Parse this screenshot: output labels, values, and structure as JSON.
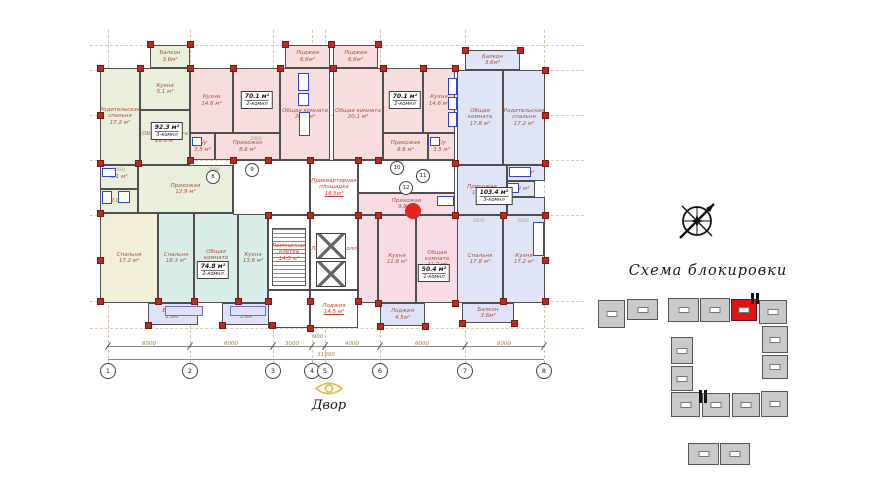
{
  "labels": {
    "scheme_title": "Схема блокировки",
    "courtyard": "Двор",
    "total_dim": "31900"
  },
  "fills": {
    "green": "#e9efda",
    "yellow": "#f3eed8",
    "teal": "#d9eee9",
    "pink": "#f7dddd",
    "pink2": "#f9dbe6",
    "blue": "#dfe4f6",
    "per": "#dfe2f6",
    "white": "#ffffff"
  },
  "grid": {
    "vxs": [
      108,
      190,
      273,
      312,
      325,
      380,
      465,
      544
    ],
    "hys": [
      45,
      70,
      115,
      160,
      215,
      301,
      328
    ]
  },
  "axis_bubbles": [
    {
      "n": "1",
      "x": 108
    },
    {
      "n": "2",
      "x": 190
    },
    {
      "n": "3",
      "x": 273
    },
    {
      "n": "4",
      "x": 312
    },
    {
      "n": "5",
      "x": 325
    },
    {
      "n": "6",
      "x": 380
    },
    {
      "n": "7",
      "x": 465
    },
    {
      "n": "8",
      "x": 544
    }
  ],
  "dim_segments": [
    {
      "v": "6000",
      "x": 149,
      "y": 341
    },
    {
      "v": "6000",
      "x": 231,
      "y": 341
    },
    {
      "v": "3000",
      "x": 292,
      "y": 341
    },
    {
      "v": "900",
      "x": 318,
      "y": 334
    },
    {
      "v": "4000",
      "x": 352,
      "y": 341
    },
    {
      "v": "6000",
      "x": 422,
      "y": 341
    },
    {
      "v": "6000",
      "x": 504,
      "y": 341
    }
  ],
  "interior_dims": [
    {
      "t": "2920",
      "x": 119,
      "y": 168
    },
    {
      "t": "3980",
      "x": 214,
      "y": 168
    },
    {
      "t": "2935",
      "x": 479,
      "y": 219
    },
    {
      "t": "2820",
      "x": 523,
      "y": 219
    },
    {
      "t": "2980",
      "x": 256,
      "y": 137
    }
  ],
  "rooms": [
    {
      "id": "green-balcony",
      "name": "Балкон",
      "area": "3.6м²",
      "x": 150,
      "y": 45,
      "w": 40,
      "h": 23,
      "f": "green"
    },
    {
      "id": "green-parent-bedroom",
      "name": "Родительская спальня",
      "area": "17.2 м²",
      "x": 100,
      "y": 68,
      "w": 40,
      "h": 97,
      "f": "green"
    },
    {
      "id": "green-kitchen",
      "name": "Кухня",
      "area": "5.1 м²",
      "x": 140,
      "y": 68,
      "w": 50,
      "h": 42,
      "f": "green"
    },
    {
      "id": "green-living",
      "name": "Общая комната",
      "area": "19.6 м²",
      "x": 140,
      "y": 110,
      "w": 50,
      "h": 55,
      "f": "green"
    },
    {
      "id": "green-bath-1",
      "name": "",
      "area": "3.1 м²",
      "x": 100,
      "y": 165,
      "w": 38,
      "h": 24,
      "f": "green"
    },
    {
      "id": "green-bath-2",
      "name": "",
      "area": "2.0 м²",
      "x": 100,
      "y": 189,
      "w": 38,
      "h": 24,
      "f": "green"
    },
    {
      "id": "green-hall",
      "name": "Прихожая",
      "area": "12.9 м²",
      "x": 138,
      "y": 165,
      "w": 95,
      "h": 48,
      "f": "green"
    },
    {
      "id": "yellow-bedroom",
      "name": "Спальня",
      "area": "17.2 м²",
      "x": 100,
      "y": 213,
      "w": 58,
      "h": 90,
      "f": "yellow"
    },
    {
      "id": "yellow-balcony",
      "name": "Балкон",
      "area": "2.6м²",
      "x": 148,
      "y": 303,
      "w": 50,
      "h": 22,
      "f": "per"
    },
    {
      "id": "teal-bedroom",
      "name": "Спальня",
      "area": "18.3 м²",
      "x": 158,
      "y": 213,
      "w": 36,
      "h": 90,
      "f": "teal"
    },
    {
      "id": "teal-living",
      "name": "Общая комната",
      "area": "21.9 м²",
      "x": 194,
      "y": 213,
      "w": 44,
      "h": 90,
      "f": "teal"
    },
    {
      "id": "teal-kitchen",
      "name": "Кухня",
      "area": "13.8 м²",
      "x": 238,
      "y": 213,
      "w": 30,
      "h": 90,
      "f": "teal"
    },
    {
      "id": "teal-loggia",
      "name": "Лоджия",
      "area": "5.6м²",
      "x": 222,
      "y": 303,
      "w": 50,
      "h": 22,
      "f": "per"
    },
    {
      "id": "pink1-loggia",
      "name": "Лоджия",
      "area": "6.6м²",
      "x": 285,
      "y": 45,
      "w": 45,
      "h": 23,
      "f": "pink"
    },
    {
      "id": "pink1-kitchen",
      "name": "Кухня",
      "area": "14.6 м²",
      "x": 190,
      "y": 68,
      "w": 43,
      "h": 65,
      "f": "pink"
    },
    {
      "id": "pink1-bedroom",
      "name": "Спальня",
      "area": "16.3 м²",
      "x": 233,
      "y": 68,
      "w": 47,
      "h": 65,
      "f": "pink"
    },
    {
      "id": "pink1-living",
      "name": "Общая комната",
      "area": "20.1 м²",
      "x": 280,
      "y": 68,
      "w": 50,
      "h": 92,
      "f": "pink"
    },
    {
      "id": "pink1-wc",
      "name": "С/у",
      "area": "3.5 м²",
      "x": 190,
      "y": 133,
      "w": 25,
      "h": 27,
      "f": "pink"
    },
    {
      "id": "pink1-hall",
      "name": "Прихожая",
      "area": "8.6 м²",
      "x": 215,
      "y": 133,
      "w": 65,
      "h": 27,
      "f": "pink"
    },
    {
      "id": "pink2-loggia",
      "name": "Лоджия",
      "area": "6.6м²",
      "x": 333,
      "y": 45,
      "w": 45,
      "h": 23,
      "f": "pink"
    },
    {
      "id": "pink2-living",
      "name": "Общая комната",
      "area": "20.1 м²",
      "x": 333,
      "y": 68,
      "w": 50,
      "h": 92,
      "f": "pink"
    },
    {
      "id": "pink2-bedroom",
      "name": "Спальня",
      "area": "16.3 м²",
      "x": 383,
      "y": 68,
      "w": 40,
      "h": 65,
      "f": "pink"
    },
    {
      "id": "pink2-kitchen",
      "name": "Кухня",
      "area": "14.6 м²",
      "x": 423,
      "y": 68,
      "w": 32,
      "h": 65,
      "f": "pink"
    },
    {
      "id": "pink2-hall",
      "name": "Прихожая",
      "area": "8.6 м²",
      "x": 383,
      "y": 133,
      "w": 45,
      "h": 27,
      "f": "pink"
    },
    {
      "id": "pink2-wc",
      "name": "С/у",
      "area": "3.5 м²",
      "x": 428,
      "y": 133,
      "w": 27,
      "h": 27,
      "f": "pink"
    },
    {
      "id": "core-corridor-1",
      "name": "",
      "area": "",
      "x": 233,
      "y": 160,
      "w": 77,
      "h": 55,
      "f": "white"
    },
    {
      "id": "core-entry-area",
      "name": "Приквартирная площадка",
      "area": "16.5м²",
      "x": 310,
      "y": 160,
      "w": 48,
      "h": 55,
      "f": "white",
      "core": true
    },
    {
      "id": "core-corridor-2",
      "name": "",
      "area": "",
      "x": 358,
      "y": 160,
      "w": 97,
      "h": 33,
      "f": "white"
    },
    {
      "id": "core-stair-cage",
      "name": "Лестничная клетка",
      "area": "14.5 м²",
      "x": 268,
      "y": 215,
      "w": 42,
      "h": 75,
      "f": "white",
      "core": true
    },
    {
      "id": "core-lift-hall",
      "name": "Лифтовый холл",
      "area": "20.7 м²",
      "x": 310,
      "y": 215,
      "w": 48,
      "h": 75,
      "f": "white",
      "core": true
    },
    {
      "id": "core-loggia",
      "name": "Лоджия",
      "area": "14.5 м²",
      "x": 310,
      "y": 290,
      "w": 48,
      "h": 38,
      "f": "white",
      "core": true
    },
    {
      "id": "core-corridor-3",
      "name": "",
      "area": "",
      "x": 268,
      "y": 290,
      "w": 42,
      "h": 38,
      "f": "white"
    },
    {
      "id": "pink3-hall",
      "name": "Прихожая",
      "area": "9.8 м²",
      "x": 358,
      "y": 193,
      "w": 97,
      "h": 22,
      "f": "pink2"
    },
    {
      "id": "pink3-gap",
      "name": "",
      "area": "",
      "x": 358,
      "y": 215,
      "w": 20,
      "h": 88,
      "f": "pink2"
    },
    {
      "id": "pink3-kitchen",
      "name": "Кухня",
      "area": "11.6 м²",
      "x": 378,
      "y": 215,
      "w": 38,
      "h": 88,
      "f": "pink2"
    },
    {
      "id": "pink3-living",
      "name": "Общая комната",
      "area": "21.2 м²",
      "x": 416,
      "y": 215,
      "w": 42,
      "h": 88,
      "f": "pink2"
    },
    {
      "id": "pink3-loggia",
      "name": "Лоджия",
      "area": "4.5м²",
      "x": 380,
      "y": 303,
      "w": 45,
      "h": 23,
      "f": "per"
    },
    {
      "id": "blue-top-balcony",
      "name": "Балкон",
      "area": "3.6м²",
      "x": 465,
      "y": 50,
      "w": 55,
      "h": 20,
      "f": "blue"
    },
    {
      "id": "blue-top-living",
      "name": "Общая комната",
      "area": "17.8 м²",
      "x": 457,
      "y": 70,
      "w": 46,
      "h": 95,
      "f": "blue"
    },
    {
      "id": "blue-top-parent-bedroom",
      "name": "Родительская спальня",
      "area": "17.2 м²",
      "x": 503,
      "y": 70,
      "w": 42,
      "h": 95,
      "f": "blue"
    },
    {
      "id": "blue-hall",
      "name": "Прихожая",
      "area": "10.2 м²",
      "x": 457,
      "y": 165,
      "w": 50,
      "h": 50,
      "f": "blue"
    },
    {
      "id": "blue-bath-1",
      "name": "",
      "area": "2.6 м²",
      "x": 507,
      "y": 165,
      "w": 38,
      "h": 16,
      "f": "blue"
    },
    {
      "id": "blue-bath-2",
      "name": "",
      "area": "2.2 м²",
      "x": 507,
      "y": 181,
      "w": 28,
      "h": 16,
      "f": "blue"
    },
    {
      "id": "blue-gap",
      "name": "",
      "area": "",
      "x": 507,
      "y": 197,
      "w": 38,
      "h": 18,
      "f": "blue"
    },
    {
      "id": "blue-bedroom",
      "name": "Спальня",
      "area": "17.8 м²",
      "x": 457,
      "y": 215,
      "w": 46,
      "h": 88,
      "f": "blue"
    },
    {
      "id": "blue-kitchen",
      "name": "Кухня",
      "area": "17.2 м²",
      "x": 503,
      "y": 215,
      "w": 42,
      "h": 88,
      "f": "blue"
    },
    {
      "id": "blue-balcony-bottom",
      "name": "Балкон",
      "area": "3.6м²",
      "x": 462,
      "y": 303,
      "w": 52,
      "h": 20,
      "f": "per"
    }
  ],
  "unit_labels": [
    {
      "area": "92.3 м²",
      "type": "3-комнл",
      "x": 167,
      "y": 131
    },
    {
      "area": "70.1 м²",
      "type": "2-комнл",
      "x": 257,
      "y": 100
    },
    {
      "area": "70.1 м²",
      "type": "2-комнл",
      "x": 405,
      "y": 100
    },
    {
      "area": "74.8 м²",
      "type": "2-комнл",
      "x": 213,
      "y": 270
    },
    {
      "area": "50.4 м²",
      "type": "1-комнл",
      "x": 434,
      "y": 273
    },
    {
      "area": "103.4 м²",
      "type": "3-комнл",
      "x": 494,
      "y": 196
    }
  ],
  "entrances": [
    {
      "n": "8",
      "x": 213,
      "y": 177
    },
    {
      "n": "9",
      "x": 252,
      "y": 170
    },
    {
      "n": "10",
      "x": 397,
      "y": 168
    },
    {
      "n": "11",
      "x": 423,
      "y": 176
    },
    {
      "n": "12",
      "x": 406,
      "y": 188
    }
  ],
  "columns": [
    [
      150,
      44
    ],
    [
      190,
      44
    ],
    [
      285,
      44
    ],
    [
      331,
      44
    ],
    [
      378,
      44
    ],
    [
      100,
      68
    ],
    [
      140,
      68
    ],
    [
      190,
      68
    ],
    [
      233,
      68
    ],
    [
      280,
      68
    ],
    [
      333,
      68
    ],
    [
      383,
      68
    ],
    [
      423,
      68
    ],
    [
      455,
      68
    ],
    [
      465,
      50
    ],
    [
      520,
      50
    ],
    [
      545,
      70
    ],
    [
      100,
      115
    ],
    [
      100,
      163
    ],
    [
      100,
      213
    ],
    [
      100,
      260
    ],
    [
      100,
      301
    ],
    [
      545,
      115
    ],
    [
      545,
      163
    ],
    [
      545,
      215
    ],
    [
      545,
      260
    ],
    [
      545,
      301
    ],
    [
      138,
      163
    ],
    [
      190,
      160
    ],
    [
      233,
      160
    ],
    [
      268,
      160
    ],
    [
      310,
      160
    ],
    [
      358,
      160
    ],
    [
      378,
      160
    ],
    [
      455,
      163
    ],
    [
      268,
      215
    ],
    [
      310,
      215
    ],
    [
      358,
      215
    ],
    [
      378,
      215
    ],
    [
      455,
      215
    ],
    [
      503,
      215
    ],
    [
      158,
      301
    ],
    [
      194,
      301
    ],
    [
      238,
      301
    ],
    [
      268,
      301
    ],
    [
      310,
      301
    ],
    [
      358,
      301
    ],
    [
      378,
      303
    ],
    [
      455,
      303
    ],
    [
      503,
      301
    ],
    [
      148,
      325
    ],
    [
      222,
      325
    ],
    [
      272,
      325
    ],
    [
      310,
      328
    ],
    [
      380,
      326
    ],
    [
      425,
      326
    ],
    [
      462,
      323
    ],
    [
      514,
      323
    ]
  ],
  "fixtures": [
    {
      "x": 102,
      "y": 168,
      "w": 14,
      "h": 9
    },
    {
      "x": 102,
      "y": 191,
      "w": 10,
      "h": 13
    },
    {
      "x": 118,
      "y": 191,
      "w": 12,
      "h": 12
    },
    {
      "x": 298,
      "y": 73,
      "w": 11,
      "h": 18
    },
    {
      "x": 298,
      "y": 93,
      "w": 11,
      "h": 13
    },
    {
      "x": 299,
      "y": 112,
      "w": 11,
      "h": 24
    },
    {
      "x": 448,
      "y": 78,
      "w": 9,
      "h": 17
    },
    {
      "x": 448,
      "y": 97,
      "w": 9,
      "h": 13
    },
    {
      "x": 448,
      "y": 112,
      "w": 9,
      "h": 15
    },
    {
      "x": 437,
      "y": 196,
      "w": 17,
      "h": 10
    },
    {
      "x": 509,
      "y": 167,
      "w": 22,
      "h": 10
    },
    {
      "x": 507,
      "y": 183,
      "w": 12,
      "h": 10
    },
    {
      "x": 533,
      "y": 222,
      "w": 11,
      "h": 34
    },
    {
      "x": 192,
      "y": 137,
      "w": 10,
      "h": 9
    },
    {
      "x": 430,
      "y": 137,
      "w": 10,
      "h": 9
    },
    {
      "x": 165,
      "y": 306,
      "w": 38,
      "h": 10,
      "per": true
    },
    {
      "x": 230,
      "y": 306,
      "w": 36,
      "h": 10,
      "per": true
    }
  ],
  "elevators": [
    {
      "x": 316,
      "y": 233,
      "w": 30,
      "h": 26
    },
    {
      "x": 316,
      "y": 261,
      "w": 30,
      "h": 26
    }
  ],
  "stairs": {
    "x": 272,
    "y": 228,
    "w": 34,
    "h": 58
  },
  "red_dot": {
    "x": 413,
    "y": 211,
    "r": 8
  },
  "blocking": {
    "blocks": [
      {
        "x": 598,
        "y": 300,
        "w": 27,
        "h": 28
      },
      {
        "x": 627,
        "y": 299,
        "w": 31,
        "h": 21
      },
      {
        "x": 668,
        "y": 298,
        "w": 31,
        "h": 24
      },
      {
        "x": 700,
        "y": 298,
        "w": 30,
        "h": 24
      },
      {
        "x": 731,
        "y": 299,
        "w": 26,
        "h": 22,
        "hl": true
      },
      {
        "x": 759,
        "y": 300,
        "w": 28,
        "h": 24
      },
      {
        "x": 762,
        "y": 326,
        "w": 26,
        "h": 27
      },
      {
        "x": 762,
        "y": 355,
        "w": 26,
        "h": 24
      },
      {
        "x": 671,
        "y": 337,
        "w": 22,
        "h": 27
      },
      {
        "x": 671,
        "y": 366,
        "w": 22,
        "h": 25
      },
      {
        "x": 671,
        "y": 392,
        "w": 29,
        "h": 25
      },
      {
        "x": 702,
        "y": 393,
        "w": 28,
        "h": 24
      },
      {
        "x": 732,
        "y": 393,
        "w": 28,
        "h": 24
      },
      {
        "x": 761,
        "y": 391,
        "w": 27,
        "h": 26
      },
      {
        "x": 688,
        "y": 443,
        "w": 31,
        "h": 22
      },
      {
        "x": 720,
        "y": 443,
        "w": 30,
        "h": 22
      }
    ],
    "ticks": [
      {
        "x": 751,
        "y": 293,
        "w": 3,
        "h": 11
      },
      {
        "x": 756,
        "y": 293,
        "w": 3,
        "h": 11
      },
      {
        "x": 699,
        "y": 390,
        "w": 3,
        "h": 13
      },
      {
        "x": 704,
        "y": 390,
        "w": 3,
        "h": 13
      }
    ]
  }
}
